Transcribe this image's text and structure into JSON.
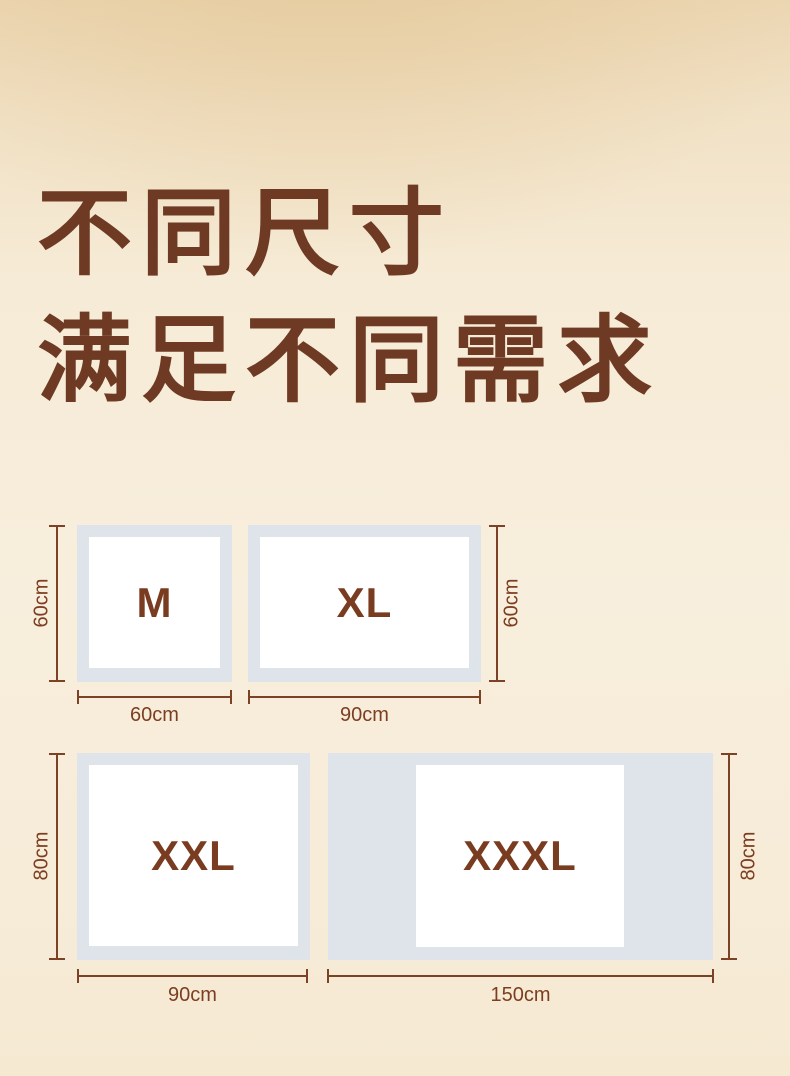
{
  "title": {
    "line1": "不同尺寸",
    "line2": "满足不同需求"
  },
  "diagrams": [
    {
      "id": "m",
      "label": "M",
      "width": "60cm",
      "height": "60cm"
    },
    {
      "id": "xl",
      "label": "XL",
      "width": "90cm",
      "height": "60cm"
    },
    {
      "id": "xxl",
      "label": "XXL",
      "width": "90cm",
      "height": "80cm"
    },
    {
      "id": "xxxl",
      "label": "XXXL",
      "width": "150cm",
      "height": "80cm"
    }
  ],
  "colors": {
    "title_text": "#6e3a24",
    "dimension_line": "#7b4226",
    "dimension_label": "#7c3e20",
    "size_label": "#7a3c20",
    "pad_outer": "#dfe4ea",
    "pad_core": "#ffffff",
    "background_top": "#ecd7b4",
    "background_bottom": "#f5e9d2"
  }
}
